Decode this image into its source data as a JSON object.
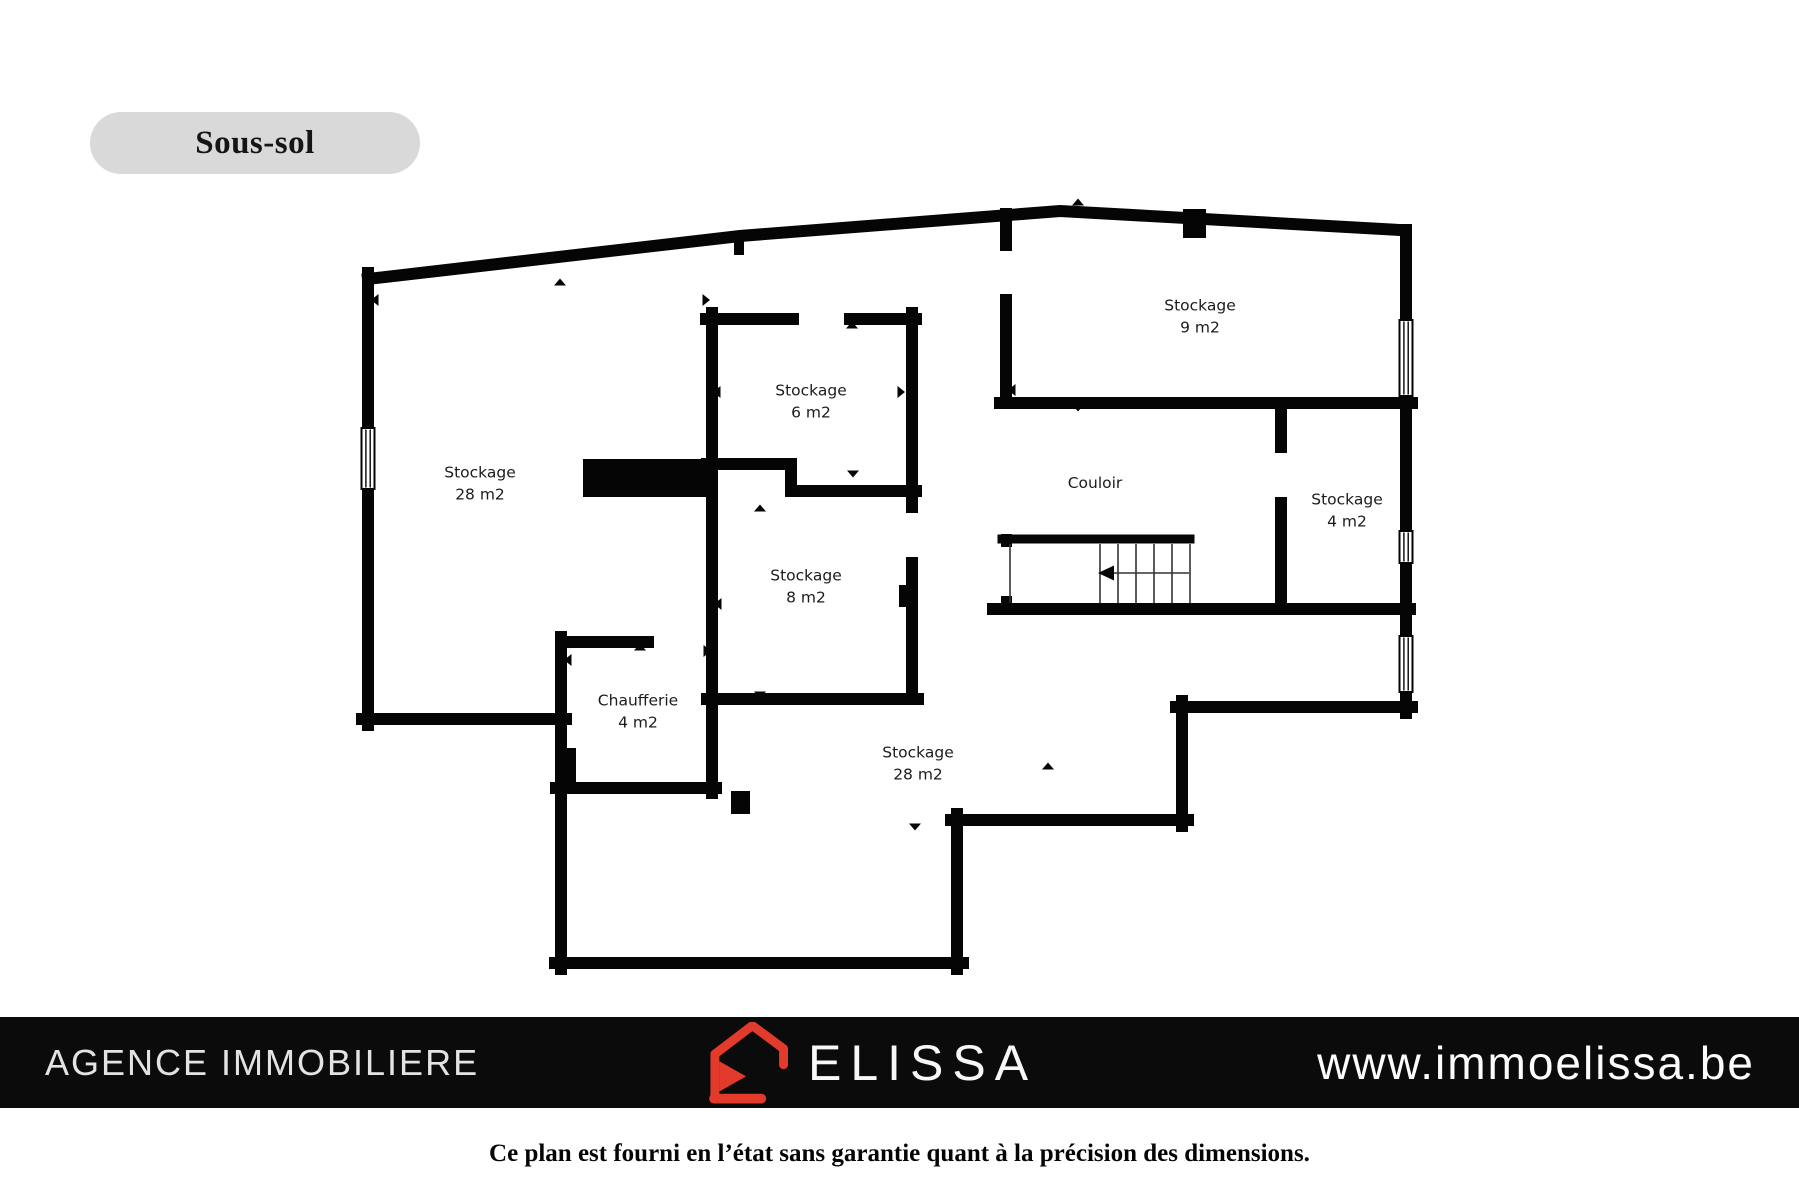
{
  "floor_label": {
    "text": "Sous-sol"
  },
  "plan": {
    "rooms": [
      {
        "id": "stockage-28-left",
        "name": "Stockage",
        "area": "28 m2"
      },
      {
        "id": "stockage-6",
        "name": "Stockage",
        "area": "6 m2"
      },
      {
        "id": "stockage-9",
        "name": "Stockage",
        "area": "9 m2"
      },
      {
        "id": "couloir",
        "name": "Couloir",
        "area": ""
      },
      {
        "id": "stockage-4",
        "name": "Stockage",
        "area": "4 m2"
      },
      {
        "id": "stockage-8",
        "name": "Stockage",
        "area": "8 m2"
      },
      {
        "id": "chaufferie",
        "name": "Chaufferie",
        "area": "4 m2"
      },
      {
        "id": "stockage-28-bottom",
        "name": "Stockage",
        "area": "28 m2"
      }
    ],
    "features": [
      "stairs",
      "windows",
      "door-openings",
      "direction-markers",
      "structural-columns"
    ],
    "wall_color": "#050505",
    "background_color": "#ffffff"
  },
  "footer": {
    "agency_label": "AGENCE IMMOBILIERE",
    "brand": "ELISSA",
    "website": "www.immoelissa.be",
    "bar_color": "#0b0b0b",
    "logo_color": "#e23b2c",
    "logo_icon": "house-outline-icon"
  },
  "disclaimer": {
    "text": "Ce plan est fourni en l’état sans garantie quant à la précision des dimensions."
  },
  "title_pill_color": "#d9d9d9"
}
